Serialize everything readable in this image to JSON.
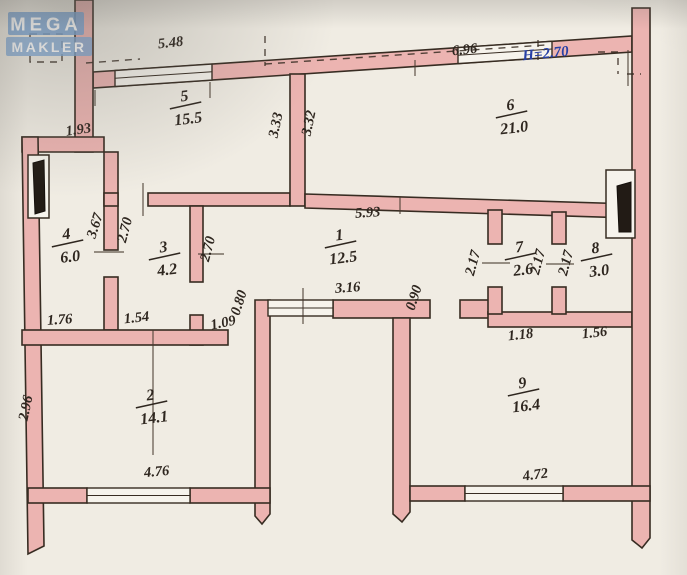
{
  "logo": {
    "line1": "MEGA",
    "line2": "MAKLER"
  },
  "note": {
    "text": "Н=2.70"
  },
  "rooms": [
    {
      "num": "5",
      "area": "15.5",
      "x": 185,
      "y": 101
    },
    {
      "num": "6",
      "area": "21.0",
      "x": 511,
      "y": 110
    },
    {
      "num": "1",
      "area": "12.5",
      "x": 340,
      "y": 240
    },
    {
      "num": "3",
      "area": "4.2",
      "x": 164,
      "y": 252
    },
    {
      "num": "4",
      "area": "6.0",
      "x": 67,
      "y": 239
    },
    {
      "num": "7",
      "area": "2.6",
      "x": 520,
      "y": 252
    },
    {
      "num": "8",
      "area": "3.0",
      "x": 596,
      "y": 253
    },
    {
      "num": "2",
      "area": "14.1",
      "x": 151,
      "y": 400
    },
    {
      "num": "9",
      "area": "16.4",
      "x": 523,
      "y": 388
    }
  ],
  "dimensions": [
    {
      "v": "5.48",
      "x": 171,
      "y": 47,
      "r": -6
    },
    {
      "v": "6.96",
      "x": 465,
      "y": 54,
      "r": -6
    },
    {
      "v": "1.93",
      "x": 79,
      "y": 134,
      "r": -8
    },
    {
      "v": "3.33",
      "x": 280,
      "y": 126,
      "r": -78
    },
    {
      "v": "3.32",
      "x": 313,
      "y": 124,
      "r": -78
    },
    {
      "v": "5.93",
      "x": 368,
      "y": 217,
      "r": -4
    },
    {
      "v": "2.70",
      "x": 129,
      "y": 231,
      "r": -75
    },
    {
      "v": "2.70",
      "x": 212,
      "y": 250,
      "r": -75
    },
    {
      "v": "3.67",
      "x": 99,
      "y": 227,
      "r": -72
    },
    {
      "v": "1.76",
      "x": 60,
      "y": 324,
      "r": -4
    },
    {
      "v": "1.54",
      "x": 137,
      "y": 322,
      "r": -6
    },
    {
      "v": "1.09",
      "x": 224,
      "y": 327,
      "r": -12
    },
    {
      "v": "0.80",
      "x": 243,
      "y": 304,
      "r": -72
    },
    {
      "v": "3.16",
      "x": 348,
      "y": 292,
      "r": -4
    },
    {
      "v": "0.90",
      "x": 418,
      "y": 299,
      "r": -72
    },
    {
      "v": "2.17",
      "x": 477,
      "y": 264,
      "r": -75
    },
    {
      "v": "2.17",
      "x": 542,
      "y": 263,
      "r": -75
    },
    {
      "v": "2.17",
      "x": 570,
      "y": 264,
      "r": -75
    },
    {
      "v": "1.18",
      "x": 521,
      "y": 339,
      "r": -6
    },
    {
      "v": "1.56",
      "x": 595,
      "y": 337,
      "r": -6
    },
    {
      "v": "2.96",
      "x": 30,
      "y": 409,
      "r": -78
    },
    {
      "v": "4.76",
      "x": 157,
      "y": 476,
      "r": -5
    },
    {
      "v": "4.72",
      "x": 536,
      "y": 479,
      "r": -8
    }
  ],
  "colors": {
    "wall_pink": "#ecb4b1",
    "line_ink": "#372c22",
    "text_ink": "#2e261f",
    "note_blue": "#2740a6",
    "paper": "#f0ece3",
    "logo_blue": "#7aa6d6",
    "vent_black": "#221b15"
  }
}
